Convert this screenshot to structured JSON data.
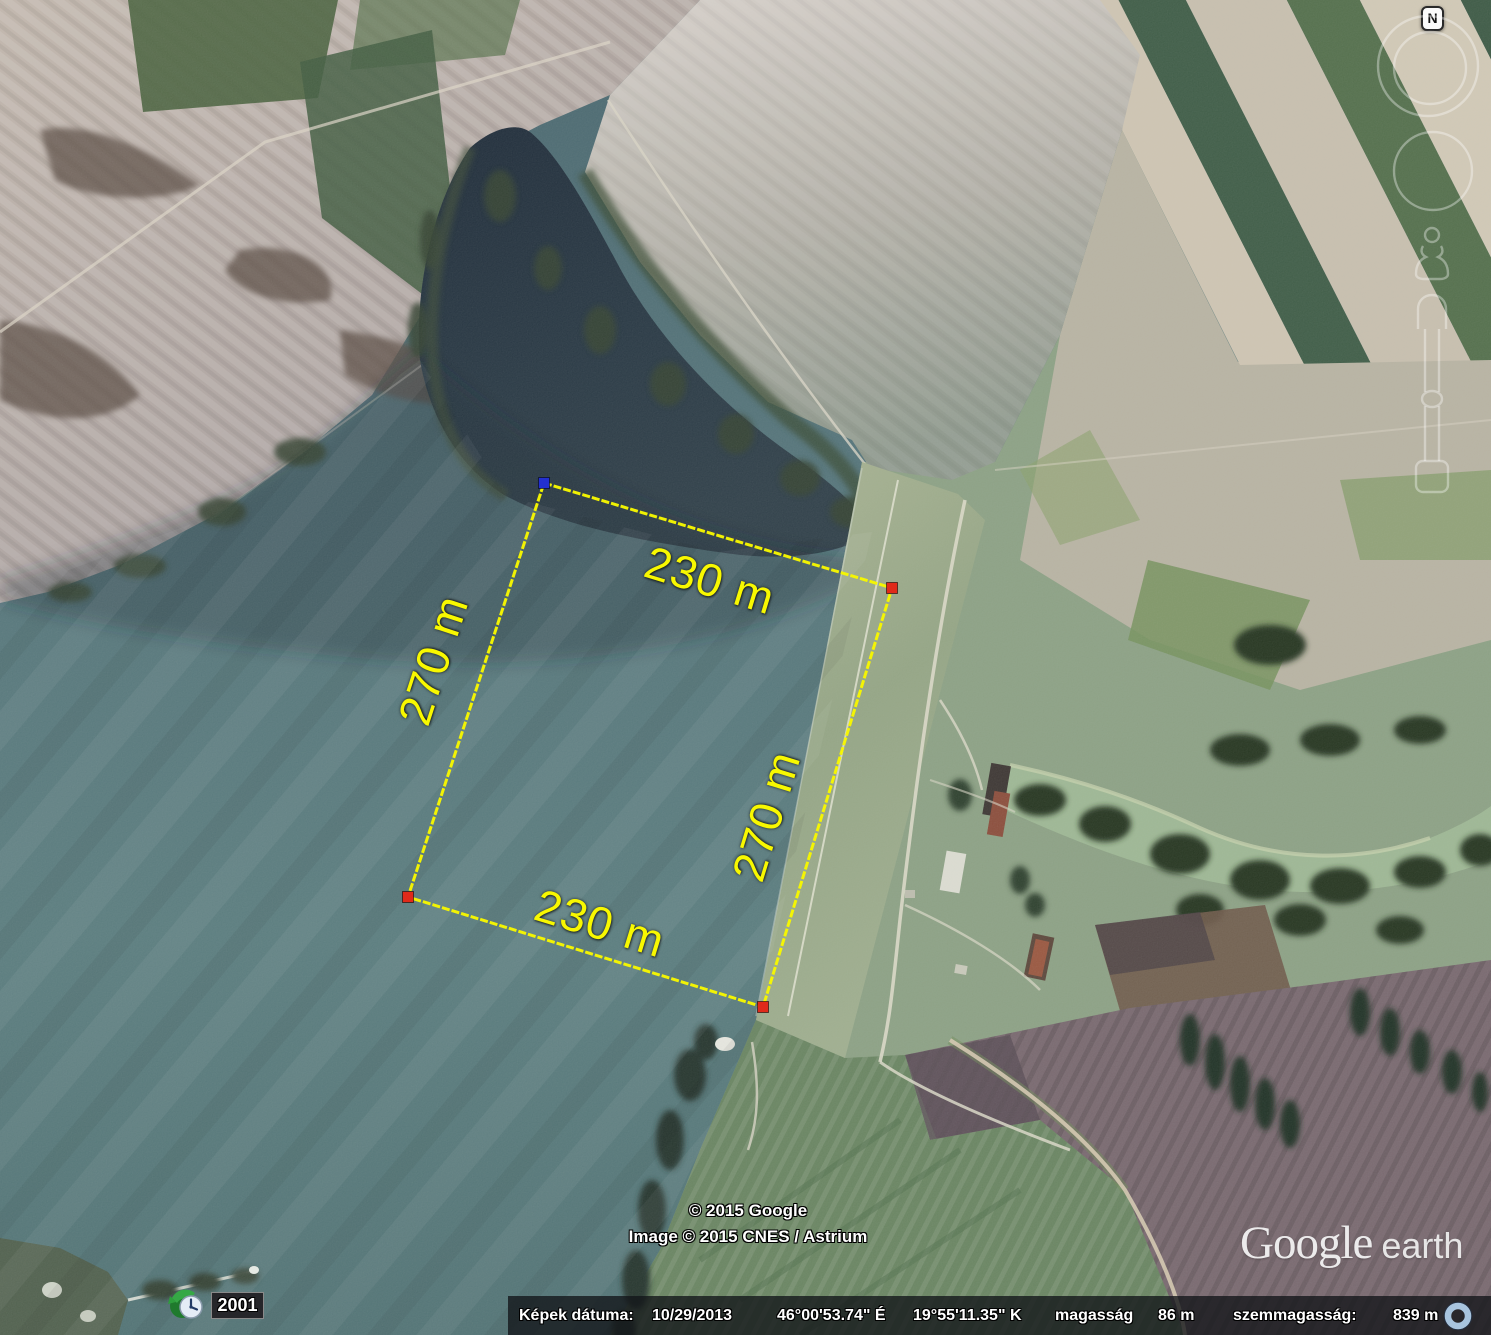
{
  "app_title": "Google Earth",
  "colors": {
    "measure_line": "#f7f700",
    "measure_label": "#f8f800",
    "marker_start": "#2330cf",
    "marker_point": "#e02a1a",
    "status_text": "#ffffff",
    "streaming_indicator": "#a8c4de"
  },
  "measurement": {
    "top_label": "230 m",
    "bottom_label": "230 m",
    "left_label": "270 m",
    "right_label": "270 m"
  },
  "copyright": {
    "line1": "© 2015 Google",
    "line2": "Image © 2015 CNES / Astrium"
  },
  "watermark": {
    "google": "Google",
    "earth": "earth"
  },
  "time_indicator": {
    "year": "2001"
  },
  "navigation": {
    "north_label": "N"
  },
  "status_bar": {
    "imagery_date_label": "Képek dátuma:",
    "imagery_date": "10/29/2013",
    "latitude": "46°00'53.74\" É",
    "longitude": "19°55'11.35\" K",
    "elevation_label": "magasság",
    "elevation": "86 m",
    "eye_altitude_label": "szemmagasság:",
    "eye_altitude": "839 m"
  }
}
